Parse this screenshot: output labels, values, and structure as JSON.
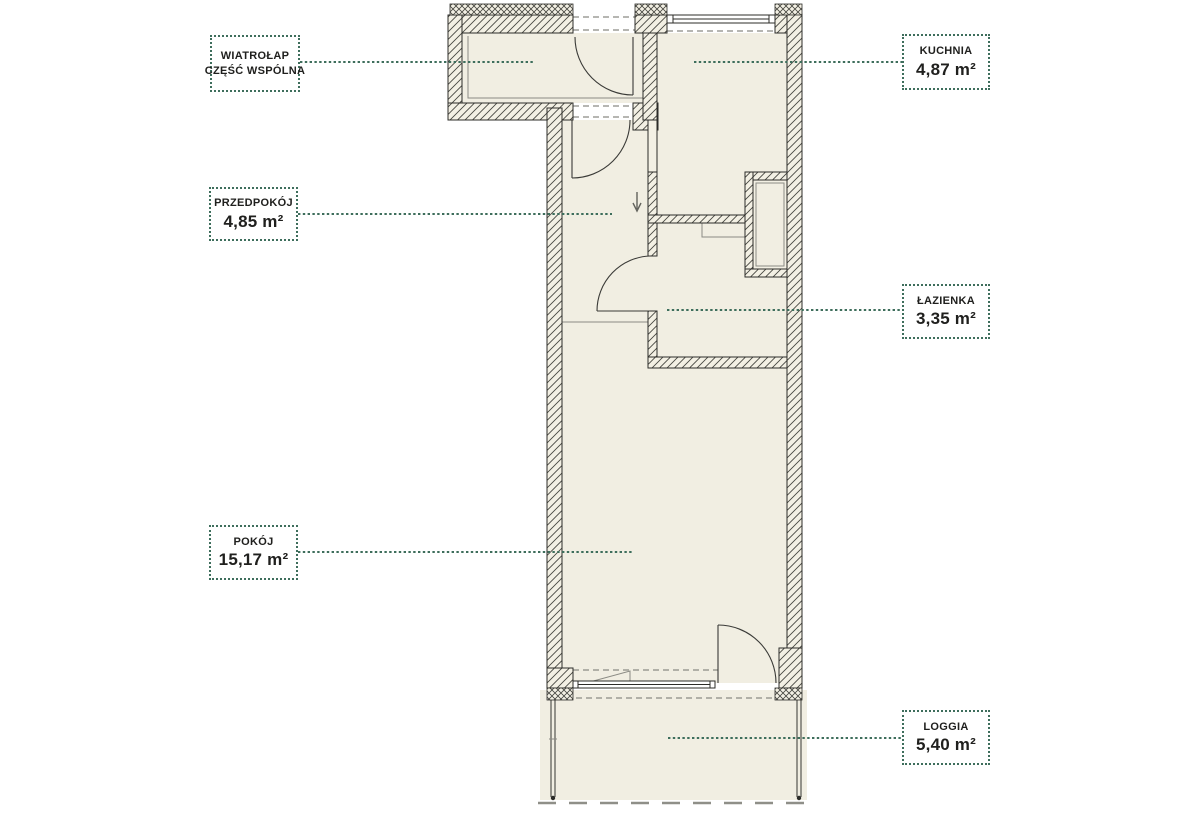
{
  "page": {
    "background": "#ffffff",
    "type_hint": "apartment floor plan"
  },
  "colors": {
    "accent_green": "#3e6e5c",
    "label_text": "#20201e",
    "floor_fill": "#f1eee2",
    "wall_fill": "#f3f0e4",
    "wall_line": "#2c2c29"
  },
  "icons": {
    "entrance_direction": "arrow-down"
  },
  "labels": {
    "wiatrolap": {
      "line1": "WIATROŁAP",
      "line2": "CZĘŚĆ WSPÓLNA"
    },
    "przedpokoj": {
      "name": "PRZEDPOKÓJ",
      "area": "4,85 m²"
    },
    "kuchnia": {
      "name": "KUCHNIA",
      "area": "4,87 m²"
    },
    "lazienka": {
      "name": "ŁAZIENKA",
      "area": "3,35 m²"
    },
    "pokoj": {
      "name": "POKÓJ",
      "area": "15,17 m²"
    },
    "loggia": {
      "name": "LOGGIA",
      "area": "5,40 m²"
    }
  }
}
